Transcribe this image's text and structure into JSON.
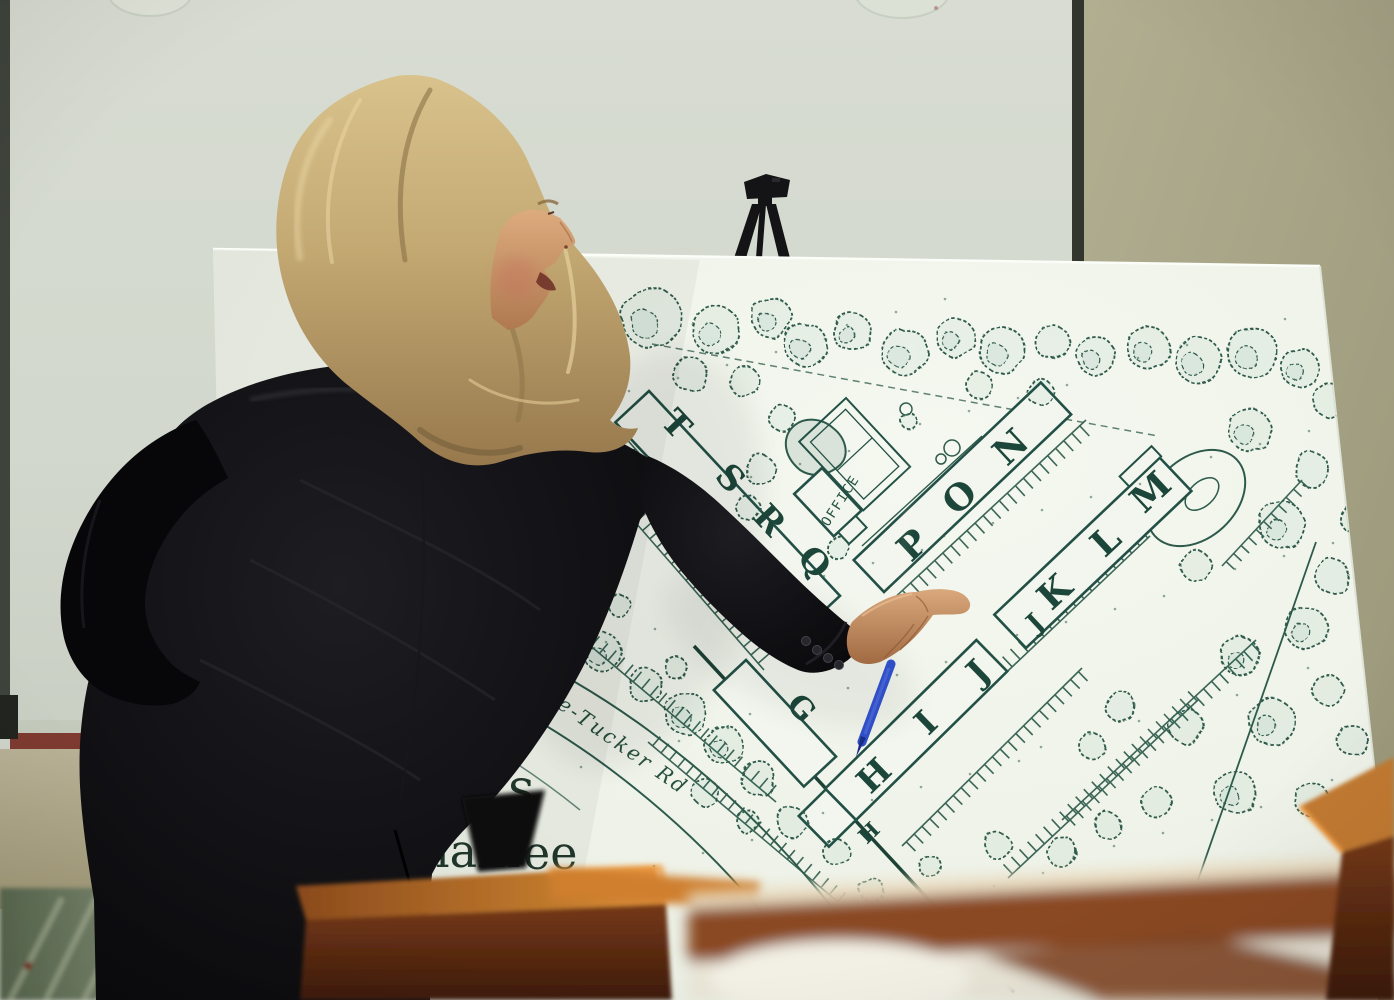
{
  "board": {
    "buildings": [
      {
        "id": "tsrq",
        "letters": [
          "T",
          "S",
          "R",
          "Q"
        ]
      },
      {
        "id": "pon",
        "letters": [
          "P",
          "O",
          "N"
        ]
      },
      {
        "id": "jklm",
        "letters": [
          "J",
          "K",
          "L",
          "M"
        ]
      },
      {
        "id": "hij",
        "letters": [
          "H",
          "I",
          "J"
        ]
      },
      {
        "id": "h-end",
        "letters": [
          "H"
        ]
      },
      {
        "id": "g",
        "letters": [
          "G"
        ]
      }
    ],
    "office_label": "OFFICE",
    "road_label": "mblee-Tucker Rd",
    "caption": {
      "line1": "s",
      "line2_left": "ham",
      "line2_right": "ee"
    }
  },
  "colors": {
    "map_ink": "#2d5a4b",
    "board_white": "#f1f5ec",
    "wall_olive": "#a9a58b",
    "screen_gray": "#d2d8cd",
    "suit_black": "#0b0b0e",
    "hair_blonde": "#c8ad79",
    "skin": "#c8936a",
    "pen_blue": "#2e4fc6",
    "wood_brown": "#8a4a22"
  }
}
